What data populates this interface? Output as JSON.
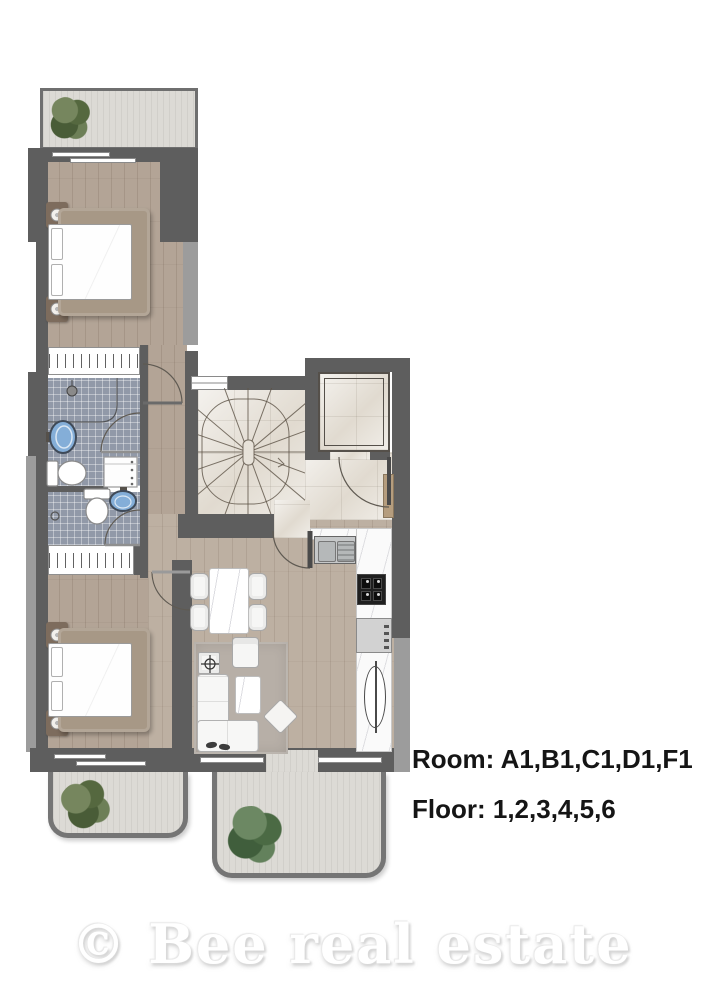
{
  "labels": {
    "room": "Room: A1,B1,C1,D1,F1",
    "floor": "Floor: 1,2,3,4,5,6"
  },
  "watermark": "© Bee real estate",
  "colors": {
    "wall": "#5e5e5e",
    "wall_light": "#9c9c9c",
    "wood": "#b3a496",
    "wood_light": "#bdb0a2",
    "tile": "#9199a8",
    "marble": "#e7e2d9",
    "balcony": "#dcdad5",
    "counter": "#fafafa",
    "sink_blue": "#84aed8",
    "rug": "#b7afa7",
    "bed_frame": "#a79886",
    "plant_green": "#5d7049"
  },
  "fixtures": [
    "double-bed",
    "wardrobe",
    "shower",
    "washbasin",
    "toilet",
    "washing-machine",
    "spiral-staircase",
    "elevator",
    "entrance-door",
    "dining-table",
    "dining-chair",
    "corner-sofa",
    "armchair",
    "coffee-table",
    "side-table",
    "ottoman",
    "kitchen-sink",
    "cooktop",
    "dishwasher",
    "kitchen-counter",
    "towel-radiator",
    "balcony-plant",
    "rug",
    "slippers",
    "window",
    "door-swing"
  ]
}
